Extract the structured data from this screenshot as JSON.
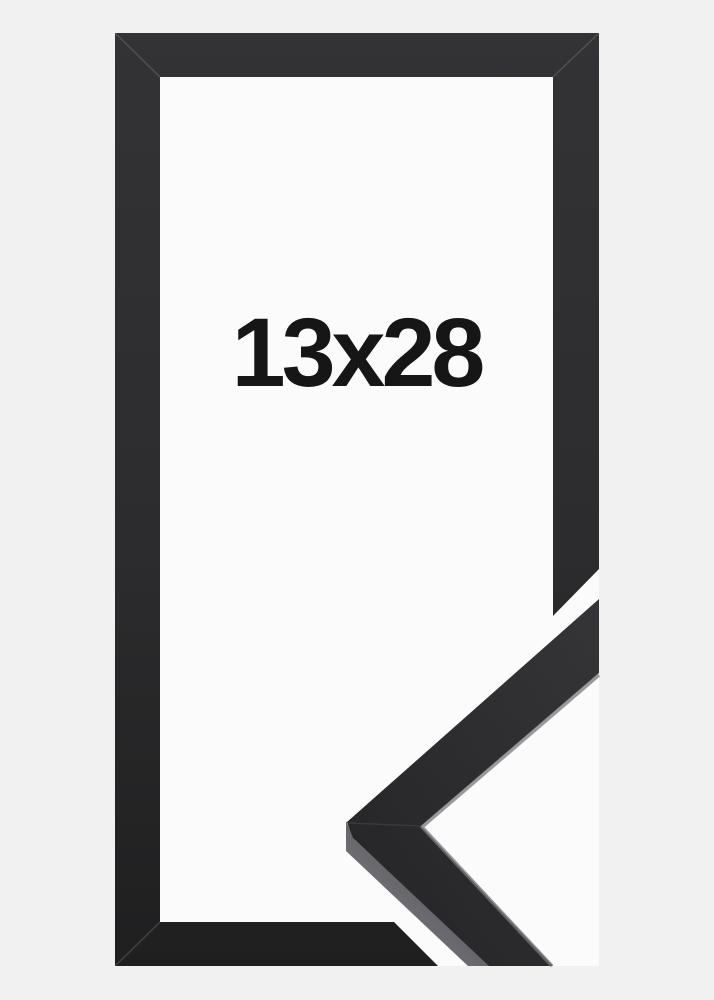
{
  "product": {
    "size_label": "13x28"
  },
  "colors": {
    "background": "#f1f1f2",
    "frame_footprint_white": "#fbfbfc",
    "frame_gradient_top": "#333336",
    "frame_gradient_mid": "#2c2c2e",
    "frame_gradient_bottom": "#1f1f20",
    "sample_face_light": "#353538",
    "sample_face_dark": "#242427",
    "sample_side_light": "#8a8a90",
    "sample_side_dark": "#3f3f44",
    "sample_edge_highlight": "#77777d",
    "sample_miter_seam": "#3b3b3f",
    "frame_corner_seam": "rgba(180,180,180,0.22)",
    "label_text": "#161616"
  }
}
